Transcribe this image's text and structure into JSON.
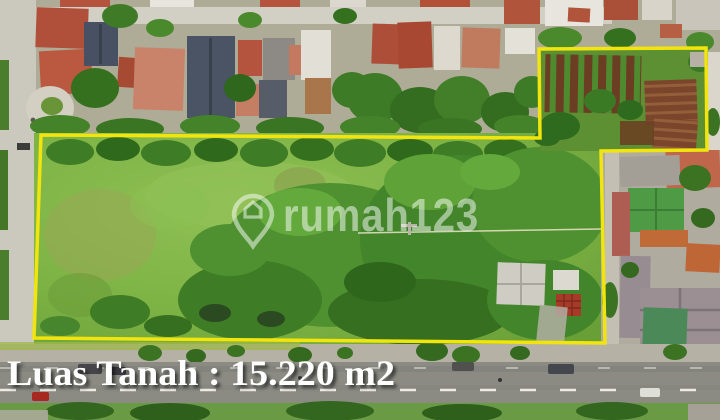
{
  "photo": {
    "caption": {
      "text": "Luas Tanah : 15.220 m2",
      "color": "#ffffff"
    },
    "watermark": {
      "text": "rumah123",
      "icon": "map-pin-house-icon",
      "color": "#ffffff"
    },
    "boundary_color": "#f2e50d"
  }
}
